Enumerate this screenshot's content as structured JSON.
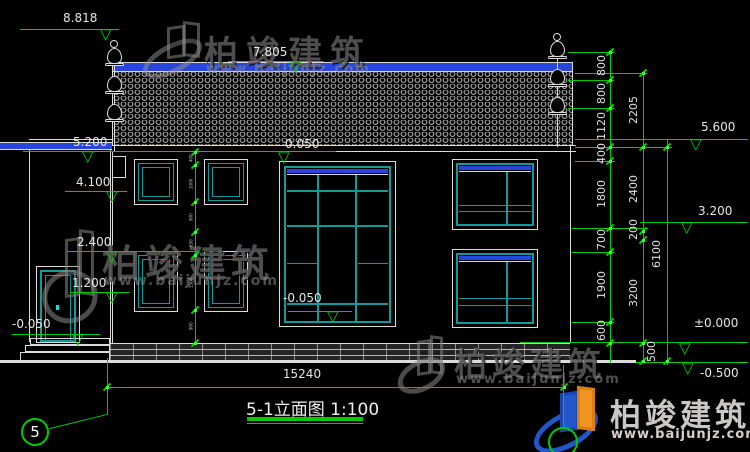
{
  "watermark": {
    "brand": "柏竣建筑",
    "url": "www.baijunjz.com"
  },
  "title": "5-1立面图 1:100",
  "grid_bubble_left": "5",
  "levels": {
    "finial_top": "8.818",
    "ridge": "7.805",
    "eaves_left": "5.200",
    "eaves_right": "5.600",
    "win2_head": "4.100",
    "mid_right": "3.200",
    "win1_head": "2.400",
    "win1_sill": "1.200",
    "entry_center_top": "0.050",
    "entry_center_bottom": "-0.050",
    "door_left": "-0.050",
    "zero": "±0.000",
    "ground": "-0.500"
  },
  "dims": {
    "total_width": "15240",
    "chain_inner": [
      "800",
      "800",
      "1120",
      "400",
      "1800",
      "700",
      "1900",
      "600"
    ],
    "chain_mid": [
      "2205",
      "2400",
      "200",
      "3200",
      "500"
    ],
    "chain_outer": [
      "6100"
    ],
    "chain_facade": [
      "400",
      "1000",
      "900",
      "650",
      "1500",
      "900"
    ]
  },
  "colors": {
    "line_green": "#00cc00",
    "frame_teal": "#12999a",
    "band_blue": "#2946dc",
    "drawing_white": "#dcdcdc"
  }
}
